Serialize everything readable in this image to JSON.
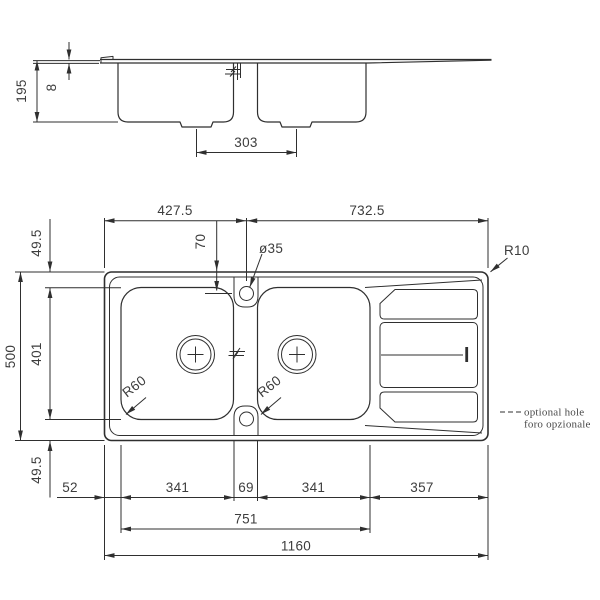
{
  "side_view": {
    "depth": "195",
    "rim_height": "8",
    "drain_spacing": "303"
  },
  "plan_view": {
    "span_left": "427.5",
    "span_right": "732.5",
    "hole_offset": "70",
    "hole_diameter": "ø35",
    "corner_radius": "R10",
    "bowl_corner_left": "R60",
    "bowl_corner_right": "R60",
    "height_total": "500",
    "bowl_height": "401",
    "margin_top": "49.5",
    "margin_bottom": "49.5",
    "margin_left": "52",
    "bowl1_width": "341",
    "center_gap": "69",
    "bowl2_width": "341",
    "drainer_width": "357",
    "bowls_span": "751",
    "width_total": "1160"
  },
  "notes": {
    "optional_hole_en": "optional hole",
    "optional_hole_it": "foro opzionale"
  },
  "colors": {
    "line": "#2f2f2f",
    "text": "#3d3d3d",
    "background": "#ffffff"
  }
}
